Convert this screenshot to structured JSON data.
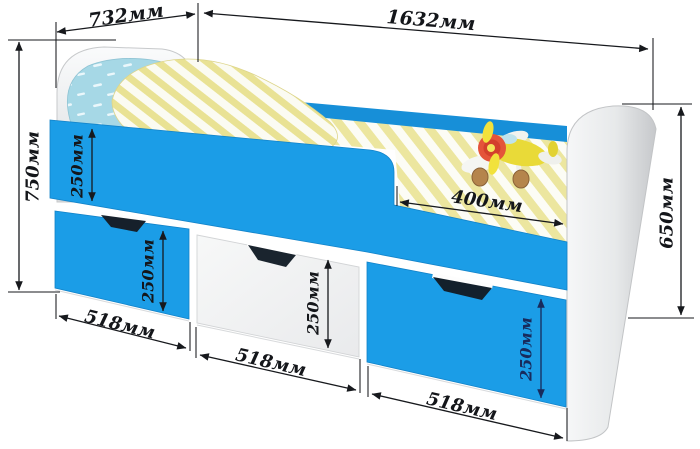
{
  "diagram": {
    "type": "furniture-dimension-diagram",
    "subject": "children's bed with side rail and three under-bed drawers",
    "units": "мм",
    "dims": {
      "headboard_width": {
        "label": "732мм",
        "value": 732
      },
      "bed_length": {
        "label": "1632мм",
        "value": 1632
      },
      "overall_height": {
        "label": "750мм",
        "value": 750
      },
      "footboard_height": {
        "label": "650мм",
        "value": 650
      },
      "opening_width": {
        "label": "400мм",
        "value": 400
      },
      "side_panel_height": {
        "label": "250мм",
        "value": 250
      },
      "drawer1_height": {
        "label": "250мм",
        "value": 250
      },
      "drawer2_height": {
        "label": "250мм",
        "value": 250
      },
      "drawer3_height": {
        "label": "250мм",
        "value": 250
      },
      "drawer1_width": {
        "label": "518мм",
        "value": 518
      },
      "drawer2_width": {
        "label": "518мм",
        "value": 518
      },
      "drawer3_width": {
        "label": "518мм",
        "value": 518
      }
    },
    "colors": {
      "panel_blue": "#1b9de7",
      "back_panel_blue": "#178fd8",
      "dimension_ink": "#17191d",
      "bedding_stripe_yellow": "#ece69f",
      "pillow_blue": "#a6d8e6",
      "wood_white": "#f2f3f4"
    }
  }
}
